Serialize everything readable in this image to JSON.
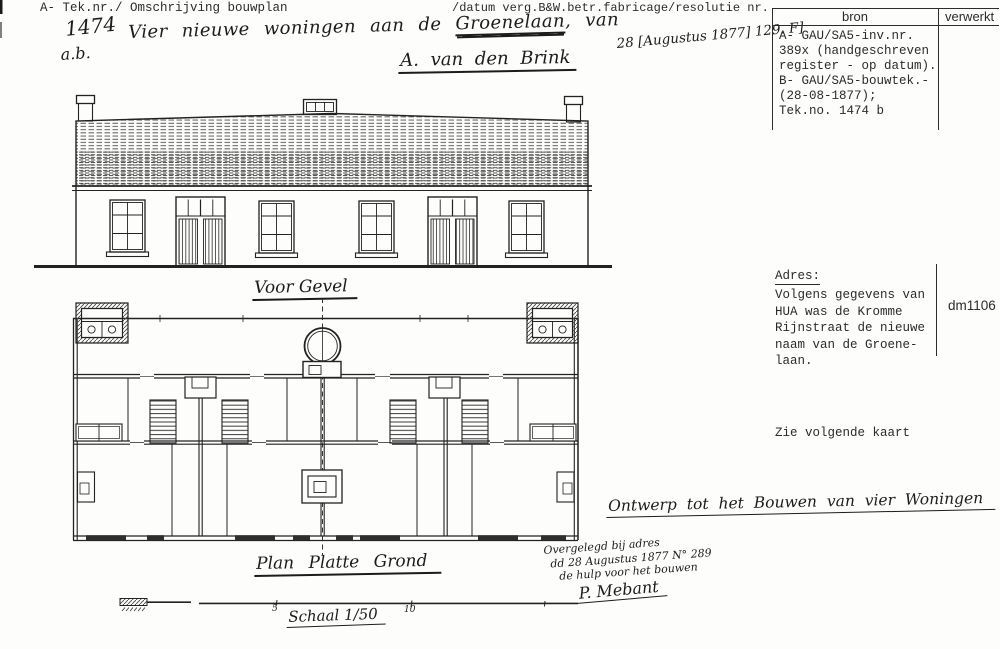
{
  "colors": {
    "ink": "#1f1f1f",
    "paper": "#fdfdfc"
  },
  "header": {
    "left": "A- Tek.nr./ Omschrijving bouwplan",
    "right": "/datum verg.B&W.betr.fabricage/resolutie nr."
  },
  "handwritten": {
    "tek_nr": "1474",
    "tek_sub": "a.b.",
    "desc_pre": "Vier nieuwe woningen aan de ",
    "desc_street": "Groenelaan",
    "desc_post": ", van",
    "applicant": "A. van den Brink",
    "date_stamp": "28 [Augustus 1877] 129. F]"
  },
  "bron_table": {
    "col_bron": "bron",
    "col_verwerkt": "verwerkt",
    "lines": [
      "A- GAU/SA5-inv.nr.",
      "389x (handgeschreven",
      "register - op datum).",
      "B- GAU/SA5-bouwtek.-",
      "(28-08-1877);",
      "Tek.no. 1474 b"
    ]
  },
  "adres": {
    "label": "Adres:",
    "lines": [
      "Volgens gegevens van",
      "HUA was de Kromme",
      "Rijnstraat de nieuwe",
      "naam van de Groene-",
      "laan."
    ],
    "code": "dm1106"
  },
  "see_note": "Zie volgende kaart",
  "drawing": {
    "elevation_caption": "Voor Gevel",
    "plan_caption": "Plan Platte Grond",
    "scale_caption": "Schaal 1/50",
    "scale_tick_5": "5",
    "scale_tick_10": "10",
    "project_title": "Ontwerp tot het Bouwen van vier Woningen",
    "approval_line1": "Overgelegd bij adres",
    "approval_line2": "dd 28 Augustus 1877 N° 289",
    "approval_line3": "de hulp voor het bouwen",
    "signature": "P. Mebant"
  }
}
